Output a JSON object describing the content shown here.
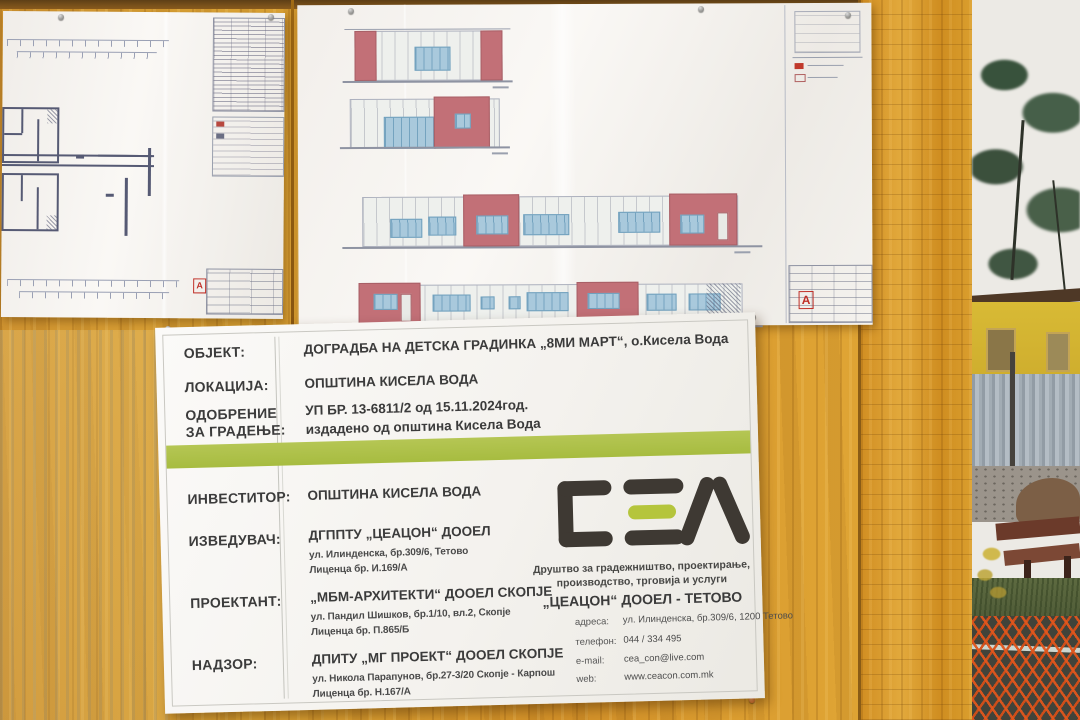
{
  "sign": {
    "project_rows": [
      {
        "label": "ОБЈЕКТ:",
        "line1": "ДОГРАДБА НА ДЕТСКА ГРАДИНКА „8МИ МАРТ“, о.Кисела Вода",
        "line2": ""
      },
      {
        "label": "ЛОКАЦИЈА:",
        "line1": "ОПШТИНА КИСЕЛА ВОДА",
        "line2": ""
      },
      {
        "label": "ОДОБРЕНИЕ ЗА ГРАДЕЊЕ:",
        "line1": "УП БР. 13-6811/2 од 15.11.2024год.",
        "line2": "издадено од општина Кисела Вода"
      }
    ],
    "party_rows": [
      {
        "label": "ИНВЕСТИТОР:",
        "name": "ОПШТИНА КИСЕЛА ВОДА",
        "addr": "",
        "lic": ""
      },
      {
        "label": "ИЗВЕДУВАЧ:",
        "name": "ДГППТУ „ЦЕАЦОН“ ДООЕЛ",
        "addr": "ул. Илинденска, бр.309/6, Тетово",
        "lic": "Лиценца бр. И.169/А"
      },
      {
        "label": "ПРОЕКТАНТ:",
        "name": "„МБМ-АРХИТЕКТИ“ ДООЕЛ СКОПЈЕ",
        "addr": "ул. Пандил Шишков, бр.1/10, вл.2, Скопје",
        "lic": "Лиценца бр. П.865/Б"
      },
      {
        "label": "НАДЗОР:",
        "name": "ДПИТУ „МГ ПРОЕКТ“ ДООЕЛ СКОПЈЕ",
        "addr": "ул. Никола Парапунов, бр.27-3/20 Скопје - Карпош",
        "lic": "Лиценца бр. Н.167/А"
      }
    ],
    "company": {
      "tagline1": "Друштво за градежништво, проектирање,",
      "tagline2": "производство, трговија и услуги",
      "name": "„ЦЕАЦОН“ ДООЕЛ - ТЕТОВО",
      "contacts": [
        {
          "label": "адреса:",
          "value": "ул. Илинденска, бр.309/6, 1200 Тетово"
        },
        {
          "label": "телефон:",
          "value": "044 / 334 495"
        },
        {
          "label": "e-mail:",
          "value": "cea_con@live.com"
        },
        {
          "label": "web:",
          "value": "www.ceacon.com.mk"
        }
      ]
    },
    "colors": {
      "accent_green": "#adc04a",
      "logo_dark": "#3e3933",
      "logo_green": "#b5c53c",
      "text": "#3b3b3b"
    }
  },
  "drawings": {
    "stamp_letter": "A",
    "colors": {
      "elevation_red": "#c27077",
      "window_blue": "#a9c9dc",
      "plan_wall": "#565a74"
    }
  }
}
